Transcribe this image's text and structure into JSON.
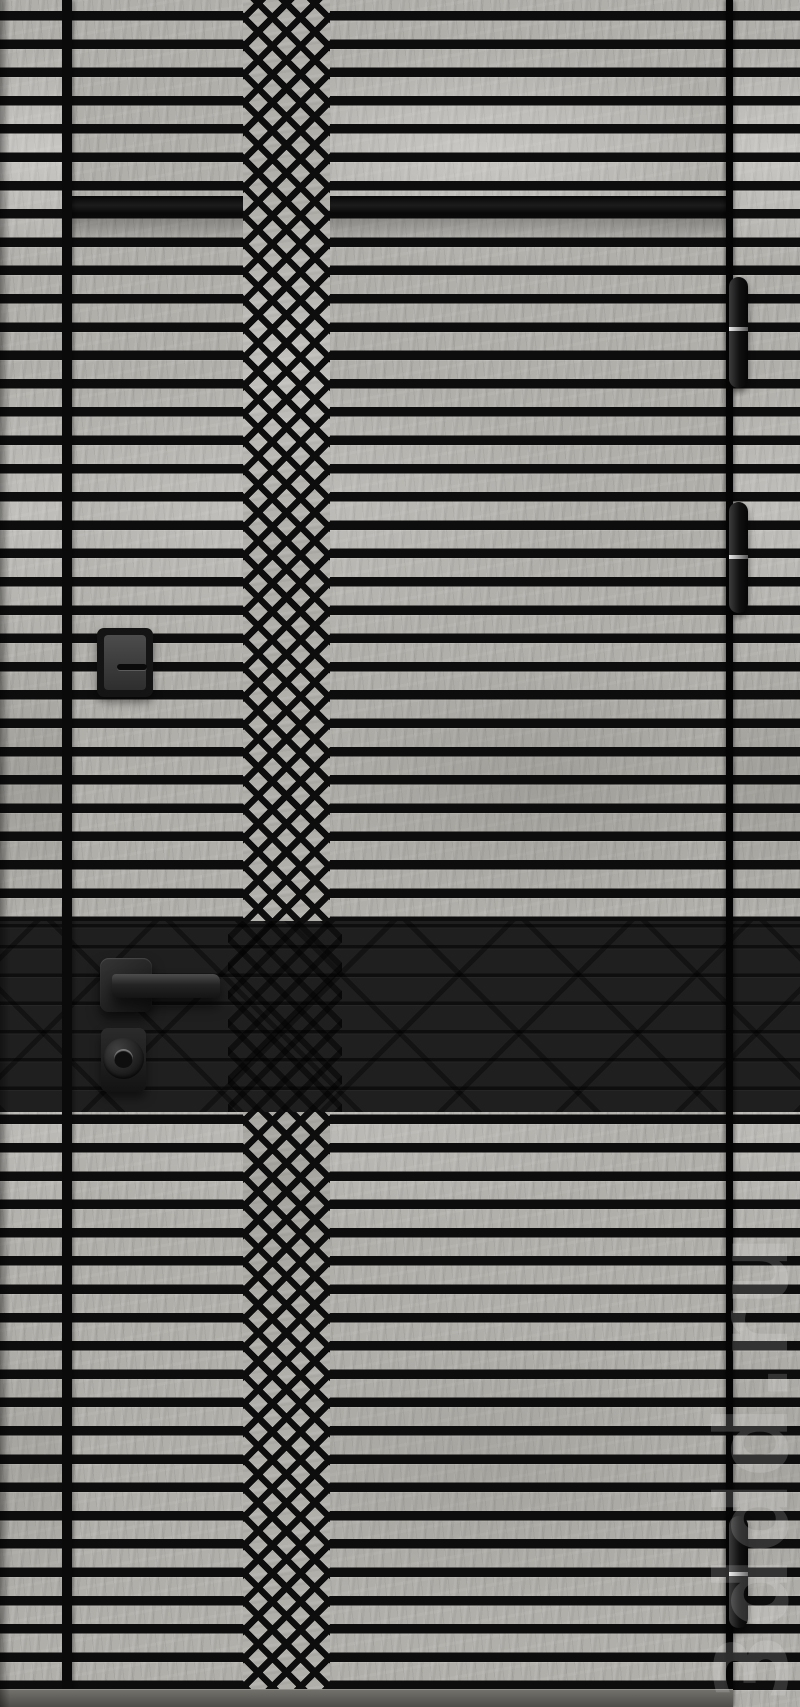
{
  "watermark": {
    "text": "3ddd.ru"
  },
  "scene": {
    "subject": "steel entry door render with horizontal black slats, center diamond lattice column and black accent band",
    "colors": {
      "texture_base": "#b1afaa",
      "slat_black": "#0d0d0d",
      "accent_band": "#1f1f1f",
      "hardware_black": "#1b1b1b",
      "hinge_highlight": "#ececec",
      "threshold_gray": "#5a5854"
    },
    "hardware": {
      "hinge_count": 3,
      "handle": "square-rose lever handle",
      "cylinder_lock": "round cylinder escutcheon below handle",
      "upper_lock": "square cover plate with horizontal slot"
    }
  }
}
